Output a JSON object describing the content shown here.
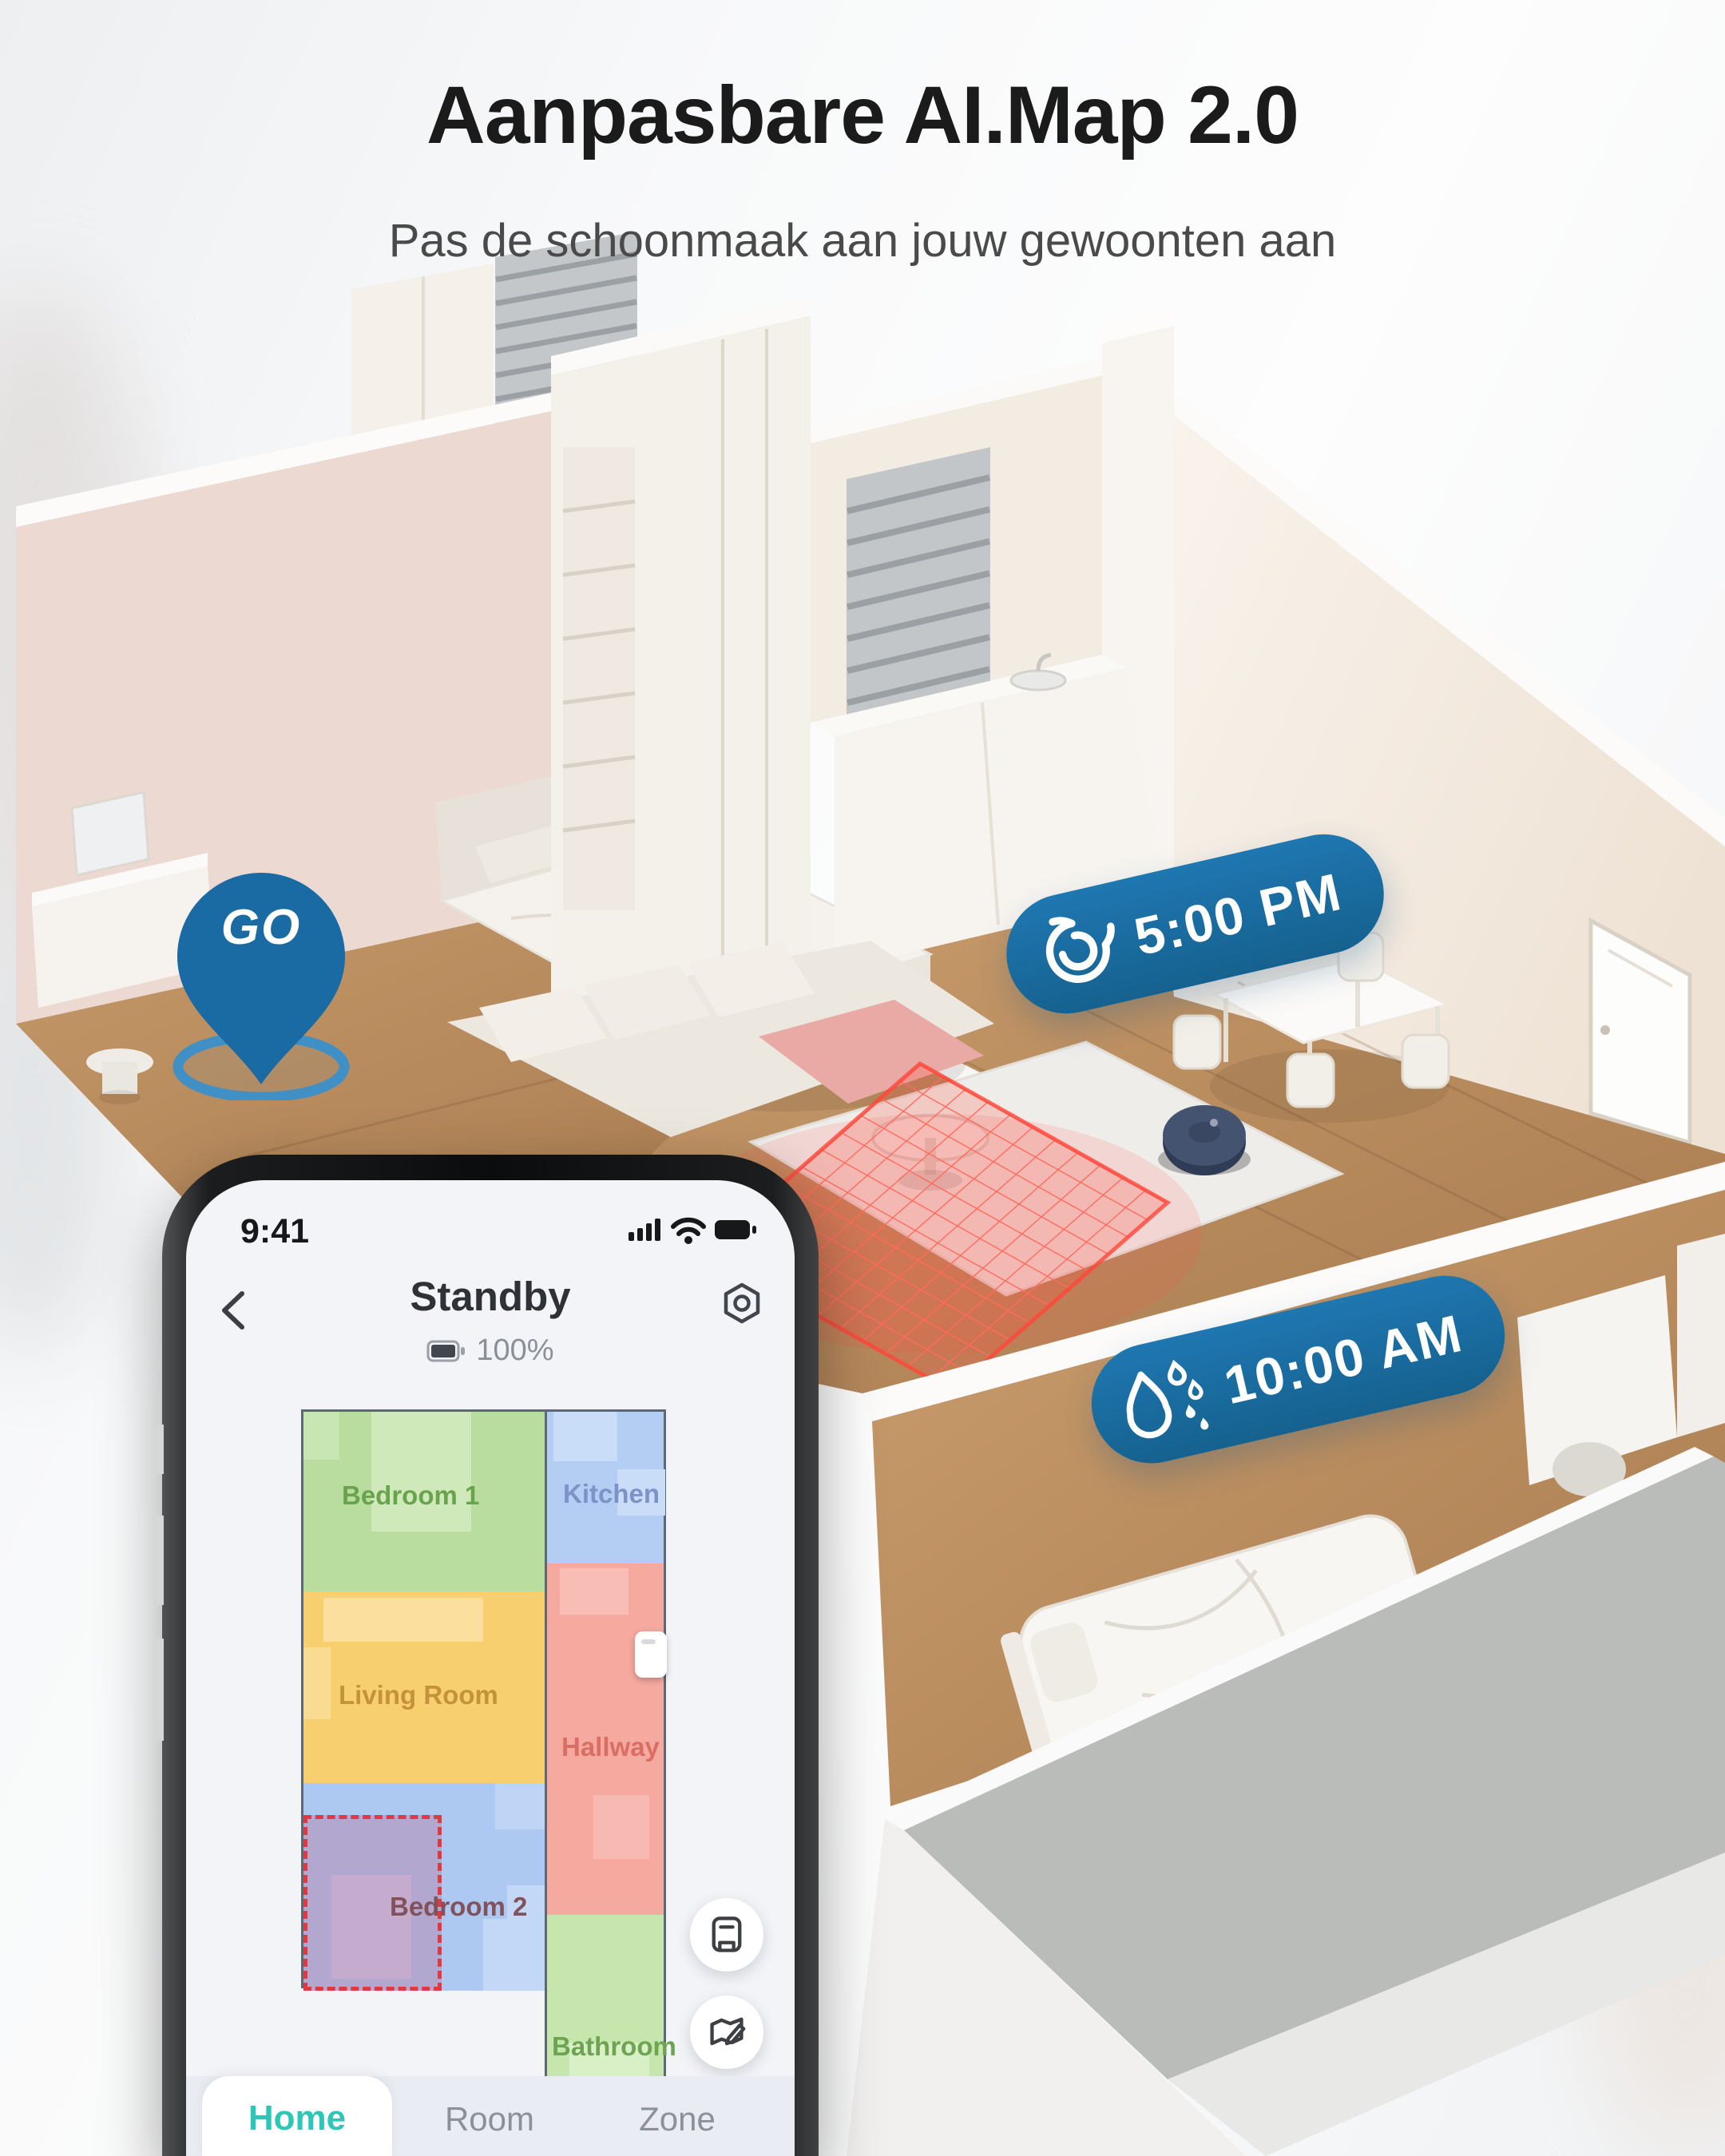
{
  "hero": {
    "title": "Aanpasbare AI.Map 2.0",
    "subtitle": "Pas de schoonmaak aan jouw gewoonten aan"
  },
  "scene": {
    "go_pin": {
      "icon": "location-pin-icon",
      "label": "GO"
    },
    "badges": [
      {
        "icon": "spin-cycle-icon",
        "time": "5:00 PM"
      },
      {
        "icon": "water-drops-icon",
        "time": "10:00 AM"
      }
    ],
    "robot": {
      "name": "robot-vacuum"
    },
    "no_go_zone": {
      "name": "no-go-zone-grid"
    }
  },
  "phone": {
    "status_bar": {
      "time": "9:41",
      "icons": [
        "cellular-signal-icon",
        "wifi-icon",
        "battery-icon"
      ]
    },
    "header": {
      "back_icon": "back-chevron-icon",
      "title": "Standby",
      "battery_icon": "robot-battery-icon",
      "battery_percent": "100%",
      "settings_icon": "settings-icon"
    },
    "map": {
      "rooms": [
        {
          "label": "Bedroom 1",
          "color": "#b9dd9e",
          "light": "#cfe9ba",
          "text_color": "#69a34e"
        },
        {
          "label": "Kitchen",
          "color": "#b4cef3",
          "light": "#c9dcf8",
          "text_color": "#7d92c6"
        },
        {
          "label": "Living Room",
          "color": "#f8cf6e",
          "light": "#fadf9f",
          "text_color": "#c3923a"
        },
        {
          "label": "Hallway",
          "color": "#f5a99f",
          "light": "#f8beb6",
          "text_color": "#d96e64"
        },
        {
          "label": "Bedroom 2",
          "color": "#aec9f1",
          "light": "#c3d8f7",
          "text_color": "#82525c"
        },
        {
          "label": "Bathroom",
          "color": "#c7e6ad",
          "light": "#d9efc5",
          "text_color": "#6da452"
        }
      ],
      "selection": {
        "room": "Bedroom 2",
        "border_color": "#e0393f",
        "fill_color": "rgba(180,138,178,0.55)"
      },
      "dock": {
        "icon": "dock-station-icon"
      }
    },
    "fabs": [
      {
        "icon": "save-map-icon"
      },
      {
        "icon": "edit-map-icon"
      }
    ],
    "tab_bar": {
      "tabs": [
        {
          "label": "Home",
          "active": true
        },
        {
          "label": "Room",
          "active": false
        },
        {
          "label": "Zone",
          "active": false
        }
      ]
    }
  },
  "colors": {
    "badge_blue": "#15618f",
    "pin_blue": "#1a6aa4",
    "accent_teal": "#2cc7b6",
    "nogo_red": "#f0453c",
    "title_black": "#1b1b1b",
    "subtitle_gray": "#4a4a4a"
  }
}
